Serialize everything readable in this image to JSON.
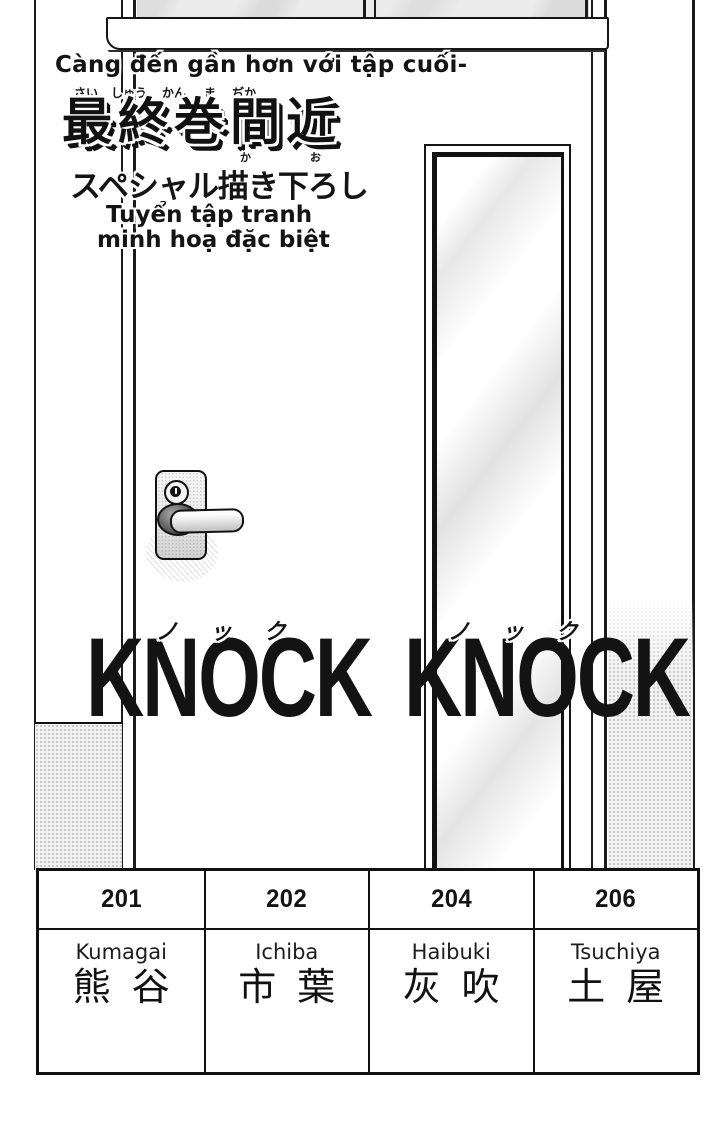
{
  "page": {
    "background": "#ffffff",
    "ink": "#141414"
  },
  "promo": {
    "tagline_vi": "Càng đến gần hơn với tập cuối-",
    "title_furigana": {
      "f1": "さい",
      "f2": "しゅう",
      "f3": "かん",
      "f4": "ま",
      "f5": "ぢか"
    },
    "title_jp": "最終巻間近",
    "subtitle_furigana": {
      "ka": "か",
      "o": "お"
    },
    "subtitle_jp": "スペシャル描き下ろし",
    "subtitle_vi_line1": "Tuyển tập tranh",
    "subtitle_vi_line2": "minh hoạ đặc biệt"
  },
  "sfx": {
    "kana_word1": {
      "k1": "ノ",
      "k2": "ッ",
      "k3": "ク"
    },
    "kana_word2": {
      "k1": "ノ",
      "k2": "ッ",
      "k3": "ク"
    },
    "word1": "KNOCK",
    "word2": "KNOCK"
  },
  "nameplates": {
    "columns": [
      {
        "room": "201",
        "romaji": "Kumagai",
        "kanji": "熊谷"
      },
      {
        "room": "202",
        "romaji": "Ichiba",
        "kanji": "市葉"
      },
      {
        "room": "204",
        "romaji": "Haibuki",
        "kanji": "灰吹"
      },
      {
        "room": "206",
        "romaji": "Tsuchiya",
        "kanji": "土屋"
      }
    ]
  }
}
